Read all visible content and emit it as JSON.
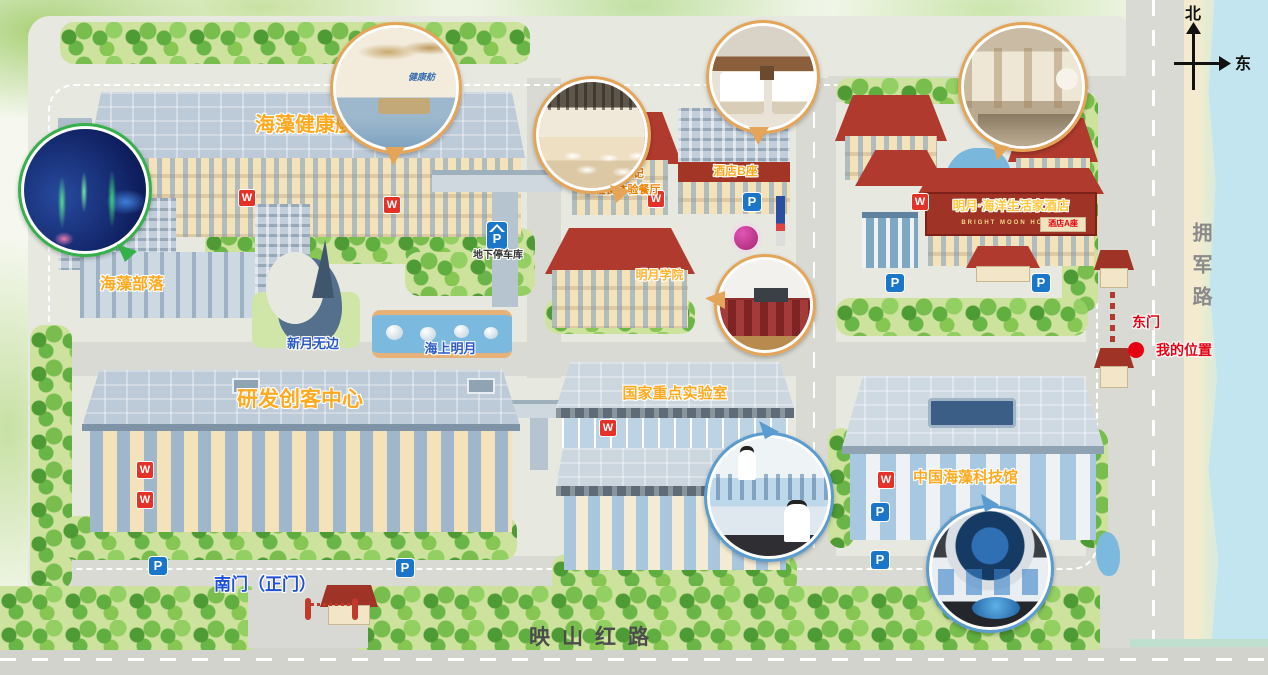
{
  "compass": {
    "north": "北",
    "east": "东"
  },
  "roads": {
    "east": "拥军路",
    "south": "映山红路"
  },
  "icons": {
    "toilet": "W",
    "parking": "P"
  },
  "gates": {
    "south": "南门（正门）",
    "east": "东门"
  },
  "marker": {
    "my_location": "我的位置"
  },
  "buildings": {
    "health_pavilion": "海藻健康舫",
    "seaweed_tribe": "海藻部落",
    "maker_center": "研发创客中心",
    "key_lab": "国家重点实验室",
    "tech_museum": "中国海藻科技馆",
    "hotel_b": "酒店B座",
    "hotel_a": "酒店A座",
    "hotel_cn": "明月·海洋生活家酒店",
    "hotel_en": "BRIGHT MOON HOTEL",
    "academy": "明月学院",
    "restaurant1": "藻食记",
    "restaurant2": "轻食体验餐厅",
    "underground_parking": "地下停车库"
  },
  "landmarks": {
    "crescent": "新月无边",
    "sea_moon": "海上明月",
    "pavilion_sign": "健康舫"
  }
}
